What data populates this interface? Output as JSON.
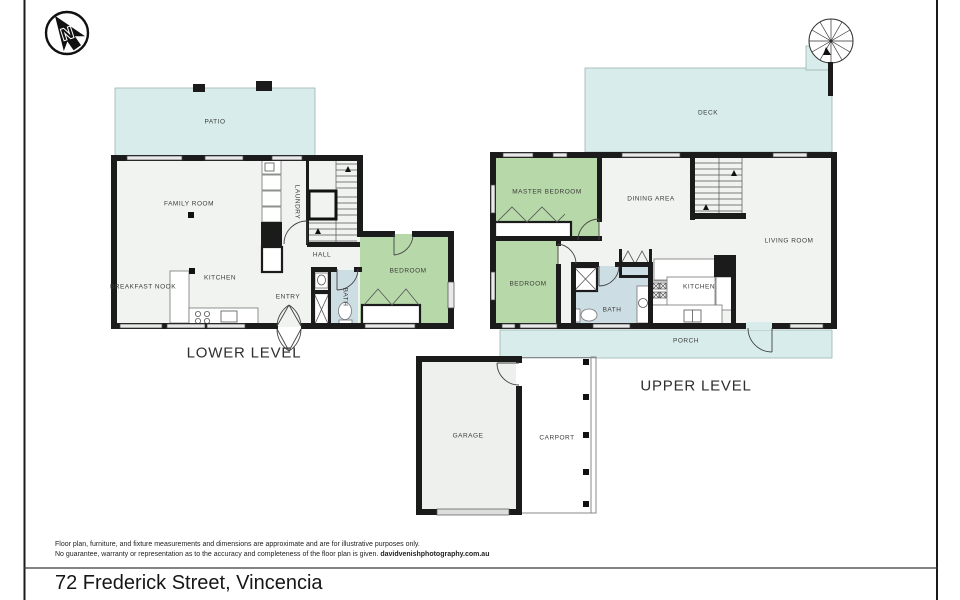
{
  "compass": {
    "label": "N"
  },
  "lower_level": {
    "title": "LOWER LEVEL",
    "rooms": {
      "patio": "PATIO",
      "family_room": "FAMILY ROOM",
      "laundry": "LAUNDRY",
      "kitchen": "KITCHEN",
      "breakfast_nook": "BREAKFAST NOOK",
      "hall": "HALL",
      "entry": "ENTRY",
      "bath": "BATH",
      "bedroom": "BEDROOM"
    }
  },
  "upper_level": {
    "title": "UPPER LEVEL",
    "rooms": {
      "deck": "DECK",
      "master_bedroom": "MASTER BEDROOM",
      "dining_area": "DINING AREA",
      "living_room": "LIVING ROOM",
      "bedroom": "BEDROOM",
      "bath": "BATH",
      "kitchen": "KITCHEN",
      "porch": "PORCH"
    }
  },
  "outbuildings": {
    "garage": "GARAGE",
    "carport": "CARPORT"
  },
  "footer": {
    "disclaimer_line1": "Floor plan, furniture, and fixture measurements and dimensions are approximate and are for illustrative purposes only.",
    "disclaimer_line2": "No guarantee, warranty or representation as to the accuracy and completeness of the floor plan is given.",
    "credit": "davidvenishphotography.com.au",
    "address": "72 Frederick Street, Vincencia"
  },
  "colors": {
    "outdoor": "#d8edeb",
    "bedroom": "#b7d8a8",
    "bath": "#ccdde4",
    "floor": "#f1f3f0",
    "wall": "#1b1b1b"
  }
}
